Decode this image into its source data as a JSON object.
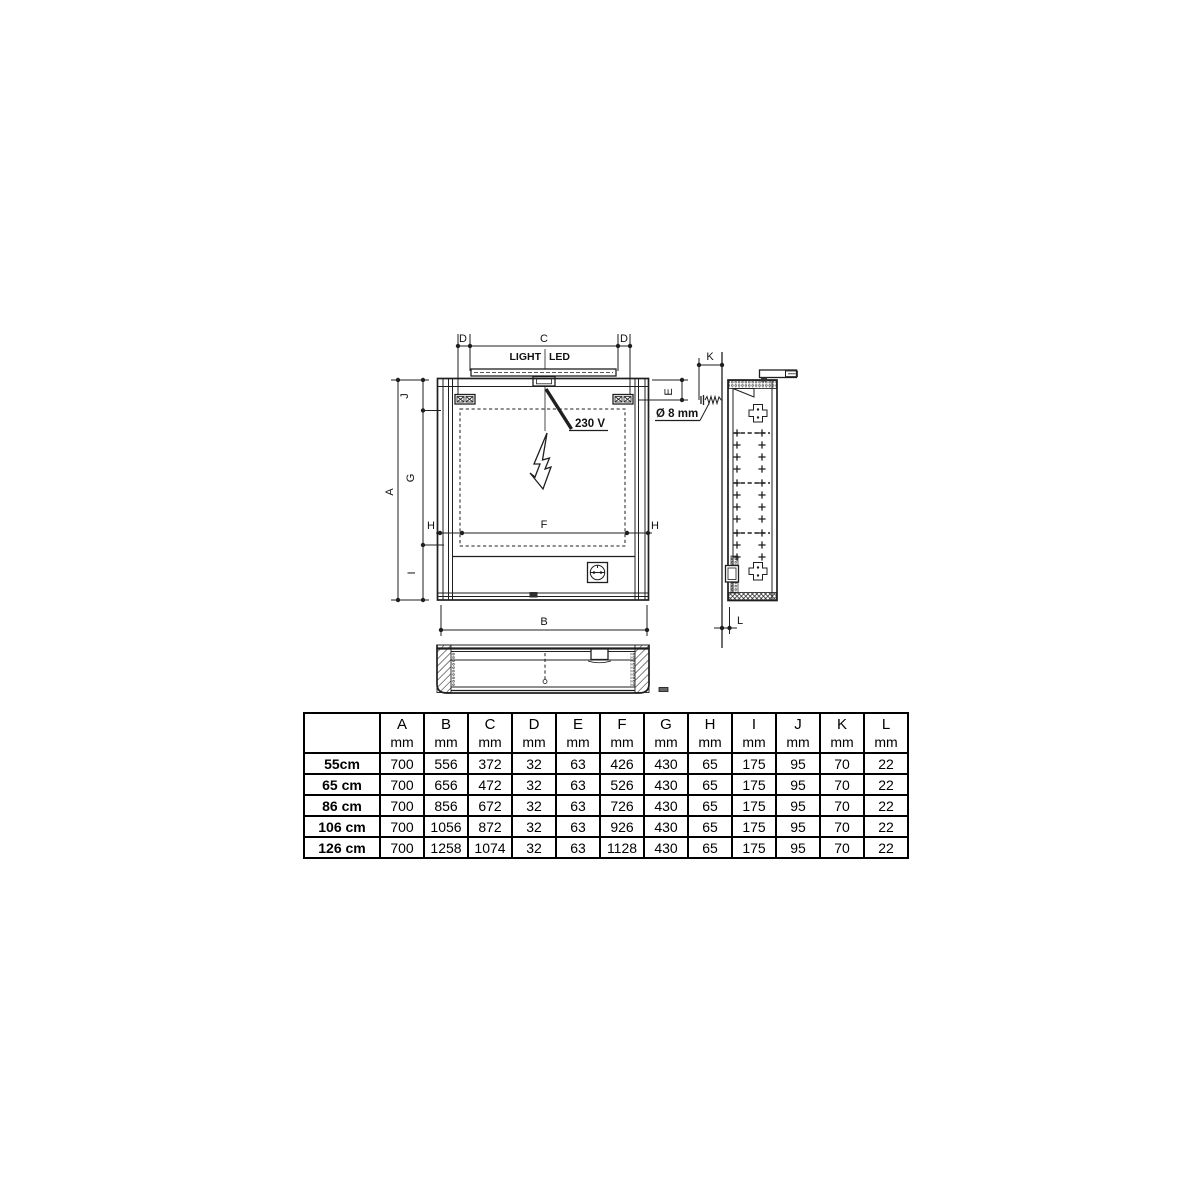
{
  "drawing": {
    "labels": {
      "A": "A",
      "B": "B",
      "C": "C",
      "D": "D",
      "E": "E",
      "F": "F",
      "G": "G",
      "H": "H",
      "I": "I",
      "J": "J",
      "K": "K",
      "L": "L"
    },
    "light_label_left": "LIGHT",
    "light_label_right": "LED",
    "voltage_label": "230 V",
    "hole_diameter_label": "Ø 8 mm"
  },
  "table": {
    "corner_label": "",
    "columns": [
      "A",
      "B",
      "C",
      "D",
      "E",
      "F",
      "G",
      "H",
      "I",
      "J",
      "K",
      "L"
    ],
    "unit": "mm",
    "rows": [
      {
        "label": "55cm",
        "values": [
          "700",
          "556",
          "372",
          "32",
          "63",
          "426",
          "430",
          "65",
          "175",
          "95",
          "70",
          "22"
        ]
      },
      {
        "label": "65 cm",
        "values": [
          "700",
          "656",
          "472",
          "32",
          "63",
          "526",
          "430",
          "65",
          "175",
          "95",
          "70",
          "22"
        ]
      },
      {
        "label": "86 cm",
        "values": [
          "700",
          "856",
          "672",
          "32",
          "63",
          "726",
          "430",
          "65",
          "175",
          "95",
          "70",
          "22"
        ]
      },
      {
        "label": "106 cm",
        "values": [
          "700",
          "1056",
          "872",
          "32",
          "63",
          "926",
          "430",
          "65",
          "175",
          "95",
          "70",
          "22"
        ]
      },
      {
        "label": "126 cm",
        "values": [
          "700",
          "1258",
          "1074",
          "32",
          "63",
          "1128",
          "430",
          "65",
          "175",
          "95",
          "70",
          "22"
        ]
      }
    ]
  },
  "colors": {
    "line": "#1f1f1f",
    "background": "#ffffff"
  }
}
